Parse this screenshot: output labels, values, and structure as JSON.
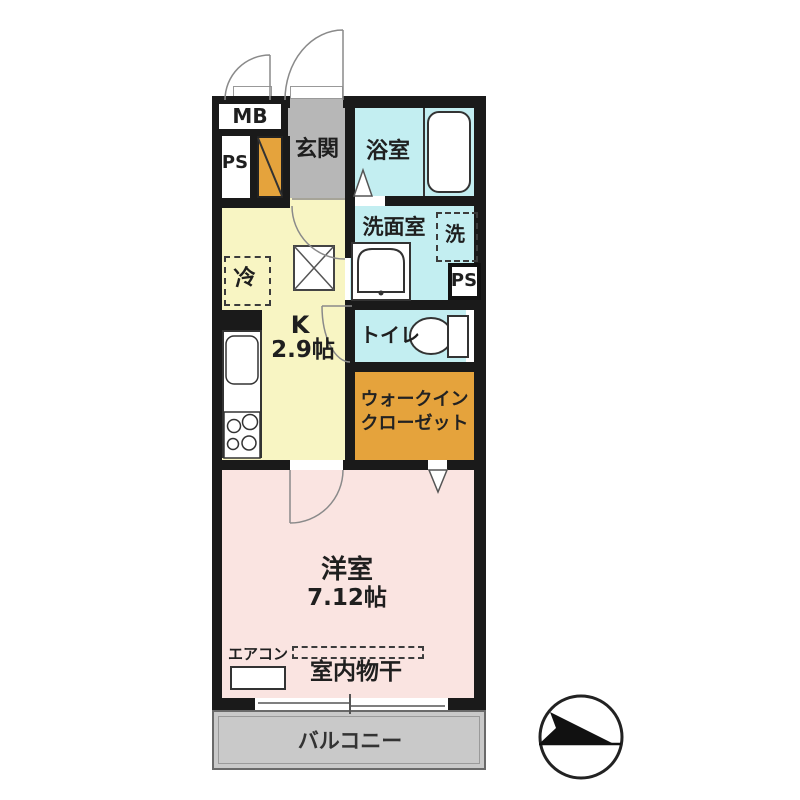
{
  "floorplan": {
    "rooms": {
      "genkan": {
        "label": "玄関"
      },
      "bathroom": {
        "label": "浴室"
      },
      "washroom": {
        "label": "洗面室"
      },
      "toilet": {
        "label": "トイレ"
      },
      "kitchen": {
        "label": "K",
        "size": "2.9帖"
      },
      "wic": {
        "label_line1": "ウォークイン",
        "label_line2": "クローゼット"
      },
      "bedroom": {
        "label": "洋室",
        "size": "7.12帖"
      },
      "balcony": {
        "label": "バルコニー"
      }
    },
    "fixtures": {
      "meter_box": "MB",
      "pipe_space_top": "PS",
      "pipe_space_side": "PS",
      "fridge_space": "冷",
      "washer_space": "洗",
      "aircon": "エアコン",
      "indoor_drying": "室内物干"
    },
    "compass": {
      "icon": "north-arrow",
      "direction": "right"
    },
    "colors": {
      "wall": "#1a1a1a",
      "water_rooms_cyan": "#c3eef1",
      "kitchen_yellow": "#f8f5c3",
      "bedroom_pink": "#fae4e1",
      "closet_orange": "#e5a33c",
      "genkan_gray": "#b7b7b7",
      "balcony_gray": "#c9c9c9"
    }
  }
}
